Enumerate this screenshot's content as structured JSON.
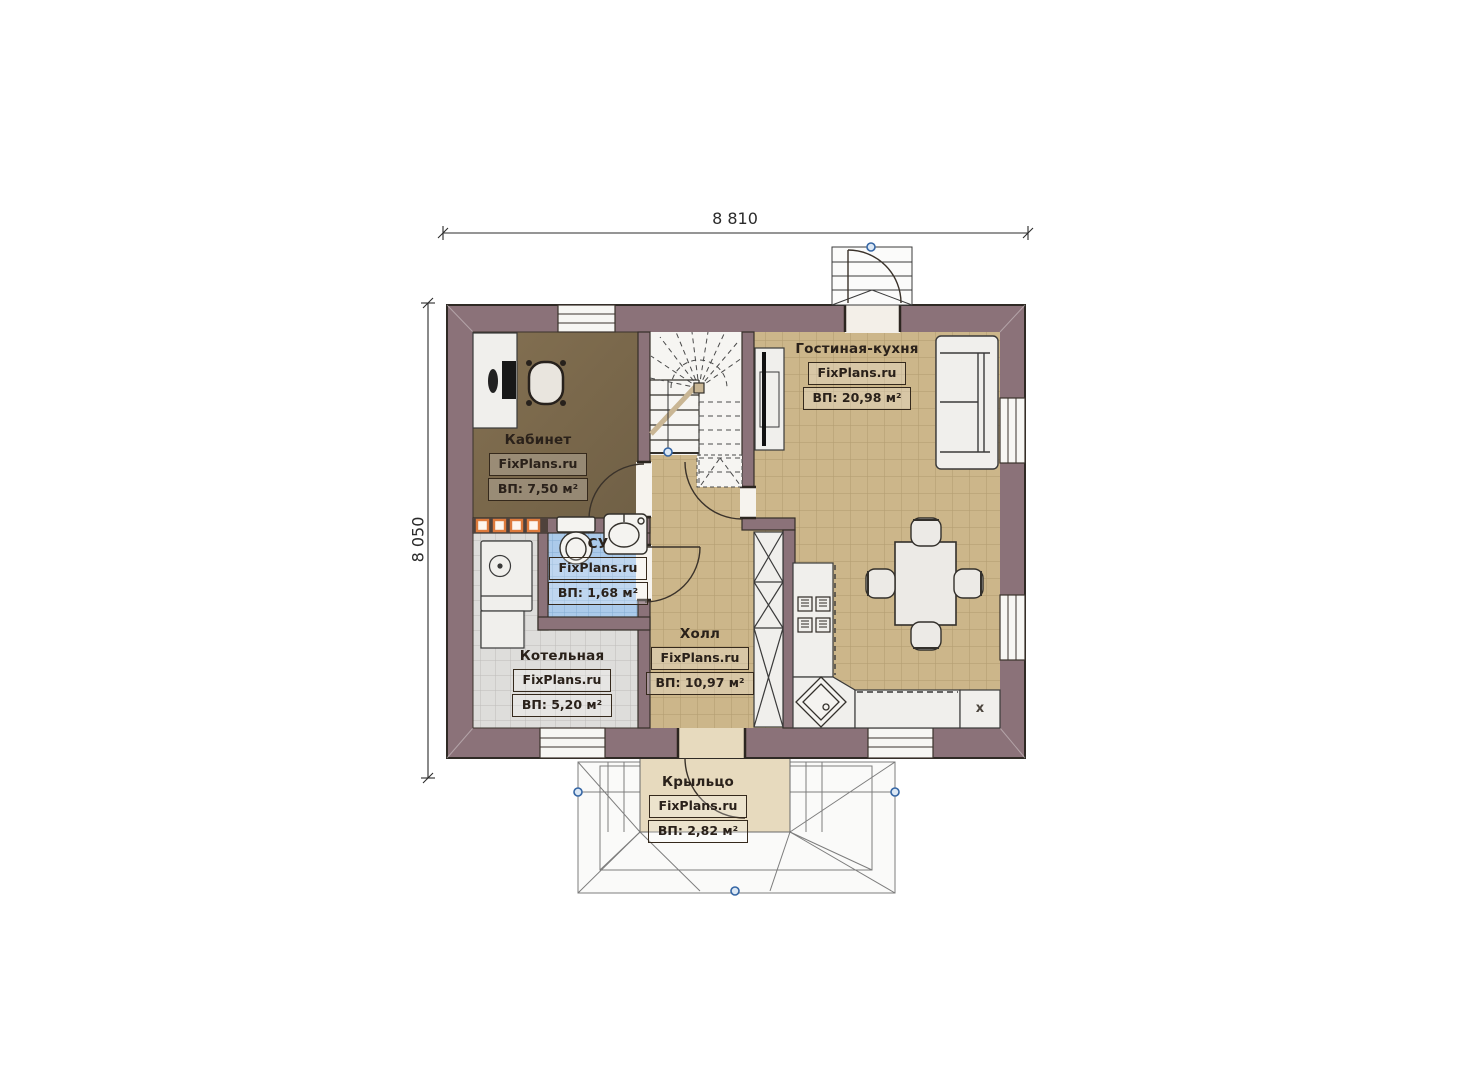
{
  "dimensions": {
    "top": "8 810",
    "left": "8 050"
  },
  "watermark": "FixPlans.ru",
  "rooms": {
    "kabinet": {
      "name": "Кабинет",
      "area": "ВП: 7,50 м²"
    },
    "su": {
      "name": "СУ",
      "area": "ВП: 1,68 м²"
    },
    "kotelnaya": {
      "name": "Котельная",
      "area": "ВП: 5,20 м²"
    },
    "holl": {
      "name": "Холл",
      "area": "ВП: 10,97 м²"
    },
    "gostinaya": {
      "name": "Гостиная-кухня",
      "area": "ВП: 20,98 м²"
    },
    "kryltso": {
      "name": "Крыльцо",
      "area": "ВП: 2,82 м²"
    }
  },
  "kitchen": {
    "fridge_label": "x"
  },
  "colors": {
    "wall": "#8b7279",
    "floor_tan": "#ccb68a",
    "floor_gray": "#dedddb",
    "floor_blue": "#abcaea",
    "floor_wood": "#7c6a4e",
    "floor_porch": "#e7dabe",
    "accent_orange": "#dd7a3c",
    "node_blue": "#3465a4"
  }
}
